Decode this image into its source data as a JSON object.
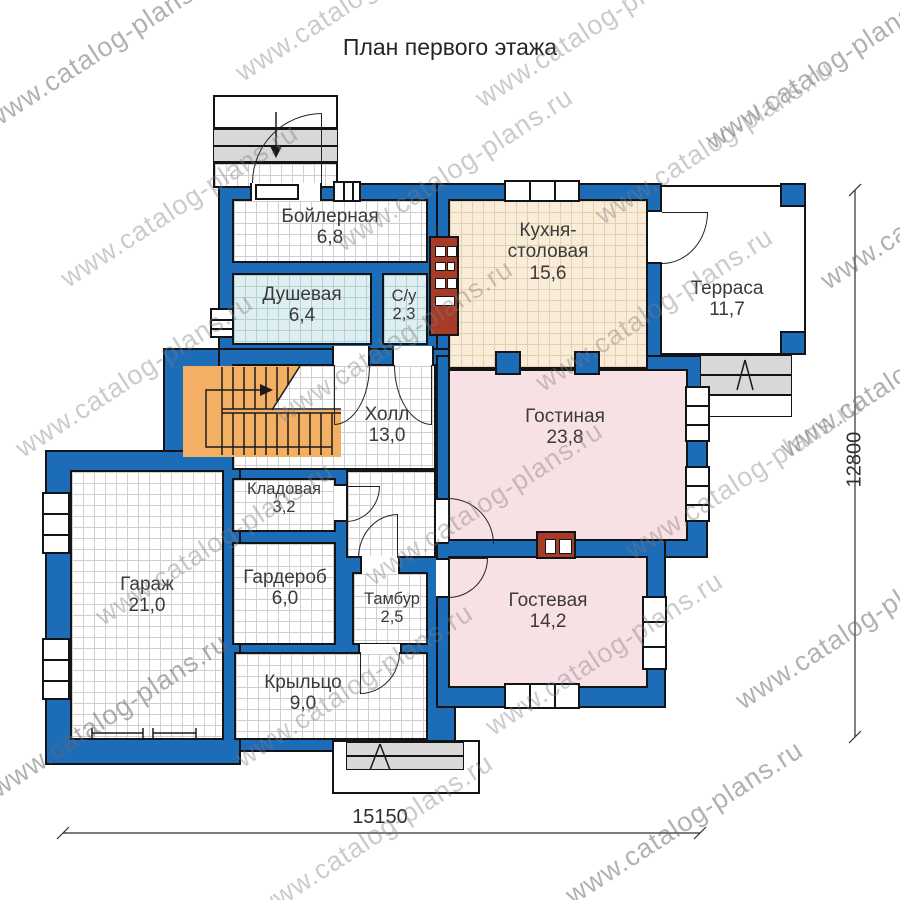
{
  "title": "План первого этажа",
  "watermark": "www.catalog-plans.ru",
  "rooms": {
    "boiler": {
      "name": "Бойлерная",
      "area": "6,8"
    },
    "shower": {
      "name": "Душевая",
      "area": "6,4"
    },
    "wc": {
      "name": "С/у",
      "area": "2,3"
    },
    "kitchen": {
      "name_line1": "Кухня-",
      "name_line2": "столовая",
      "area": "15,6"
    },
    "terrace": {
      "name": "Терраса",
      "area": "11,7"
    },
    "hall": {
      "name": "Холл",
      "area": "13,0"
    },
    "living": {
      "name": "Гостиная",
      "area": "23,8"
    },
    "storage": {
      "name": "Кладовая",
      "area": "3,2"
    },
    "wardrobe": {
      "name": "Гардероб",
      "area": "6,0"
    },
    "tambour": {
      "name": "Тамбур",
      "area": "2,5"
    },
    "garage": {
      "name": "Гараж",
      "area": "21,0"
    },
    "guest": {
      "name": "Гостевая",
      "area": "14,2"
    },
    "porch": {
      "name": "Крыльцо",
      "area": "9,0"
    }
  },
  "dimensions": {
    "width_mm": "15150",
    "height_mm": "12800"
  },
  "colors": {
    "wall_blue": "#1d6cb8",
    "stair_orange": "#f3b065",
    "floor_pink": "#f8e1e4",
    "floor_lightblue": "#dfeef0",
    "floor_tan": "#f9ecd8",
    "chimney_red": "#a63c28",
    "steps_grey": "#d8d8d8"
  }
}
